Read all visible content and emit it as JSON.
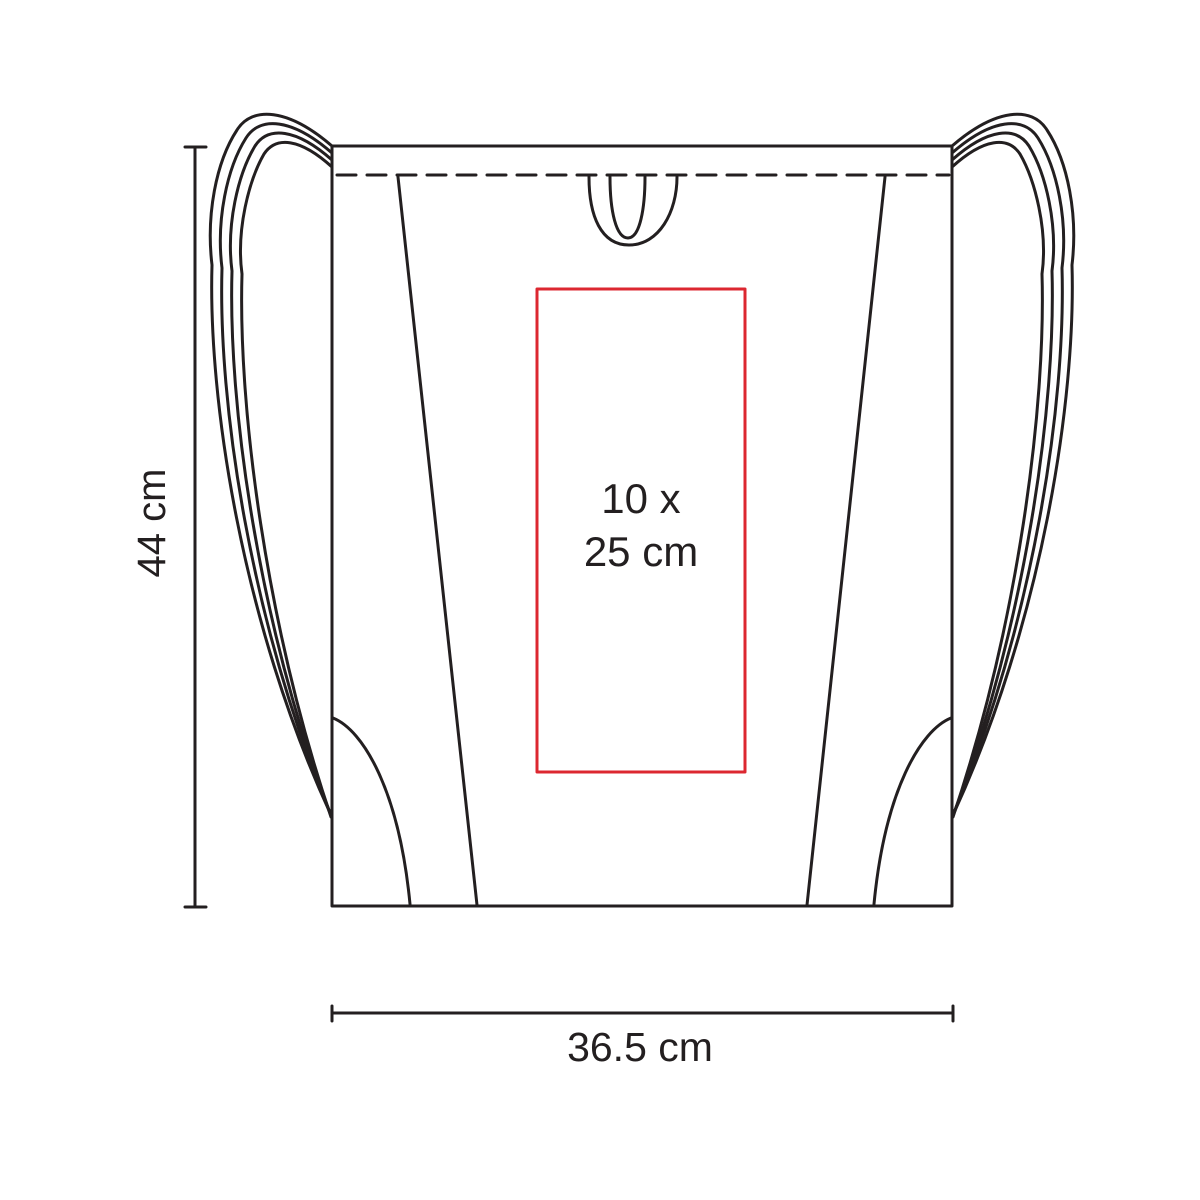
{
  "diagram": {
    "type": "product-dimension-diagram",
    "subject": "drawstring-backpack-outline",
    "dimensions": {
      "height_label": "44 cm",
      "width_label": "36.5 cm"
    },
    "print_area": {
      "line1": "10 x",
      "line2": "25 cm"
    },
    "colors": {
      "outline": "#231f20",
      "print_area_border": "#dc2730",
      "text": "#231f20",
      "background": "#ffffff"
    }
  }
}
